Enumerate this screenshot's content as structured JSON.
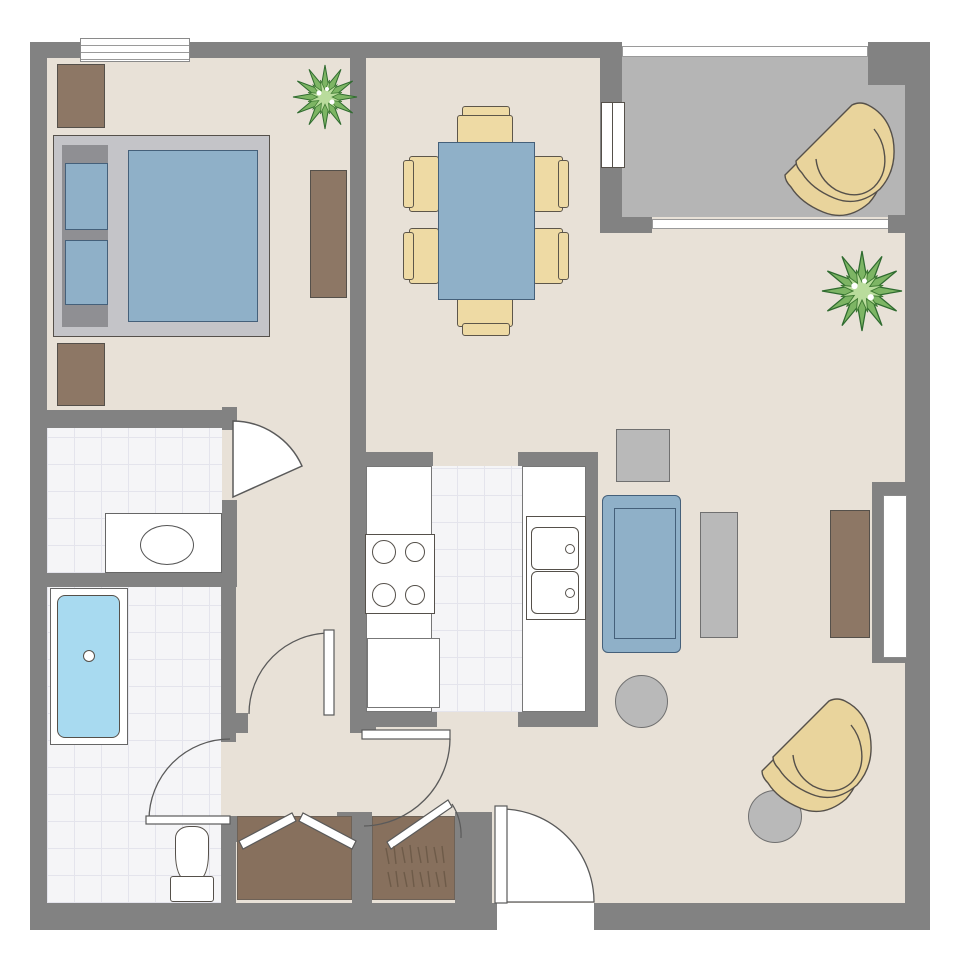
{
  "palette": {
    "wall": "#828282",
    "floor": "#e8e1d7",
    "balconyFloor": "#b5b5b5",
    "tile": "#f5f5f7",
    "tileLine": "#e4e4ec",
    "outline": "#55504a",
    "outlineSoft": "#6e6257",
    "brown": "#8d7765",
    "closetBrown": "#87705d",
    "hatchBrown": "#6e5b49",
    "blue": "#8fb0c8",
    "blueOutline": "#45607a",
    "tan": "#eedaa4",
    "tanOutline": "#5d564a",
    "grayFurn": "#b9b9b9",
    "grayFurnOutline": "#707070",
    "bedFrame": "#c4c4c8",
    "headboard": "#8f8f93",
    "tubBlue": "#a8daf0",
    "plantGreen": "#7db564",
    "plantGreenLight": "#b9dc9c",
    "plantGreenDark": "#2f6b2f",
    "doorStroke": "#5a5a5a"
  },
  "rooms": [
    {
      "id": "bedroom",
      "fixtures": [
        "bed",
        "pillows",
        "dresser-upper",
        "dresser-lower",
        "console-table",
        "plant",
        "exterior-window"
      ]
    },
    {
      "id": "dining-area",
      "fixtures": [
        "dining-table",
        "dining-chairs-x6"
      ]
    },
    {
      "id": "kitchen",
      "fixtures": [
        "left-counter",
        "stove-4-burners",
        "lower-appliance",
        "right-counter",
        "double-sink"
      ]
    },
    {
      "id": "bathroom-vanity",
      "fixtures": [
        "vanity-counter",
        "oval-sink",
        "swing-door"
      ]
    },
    {
      "id": "bathroom-main",
      "fixtures": [
        "bathtub",
        "toilet",
        "swing-door"
      ]
    },
    {
      "id": "hallway",
      "fixtures": [
        "swing-door"
      ]
    },
    {
      "id": "living-room",
      "fixtures": [
        "sofa",
        "sofa-side-square-table",
        "coffee-table",
        "tv-console",
        "round-side-table-x2",
        "lounge-chair",
        "plant",
        "side-window",
        "swing-door"
      ]
    },
    {
      "id": "entry",
      "fixtures": [
        "entry-door",
        "closet-bifold",
        "closet-with-clothes"
      ]
    },
    {
      "id": "balcony",
      "fixtures": [
        "lounge-chair",
        "sliding-glass-door",
        "railing"
      ]
    }
  ]
}
